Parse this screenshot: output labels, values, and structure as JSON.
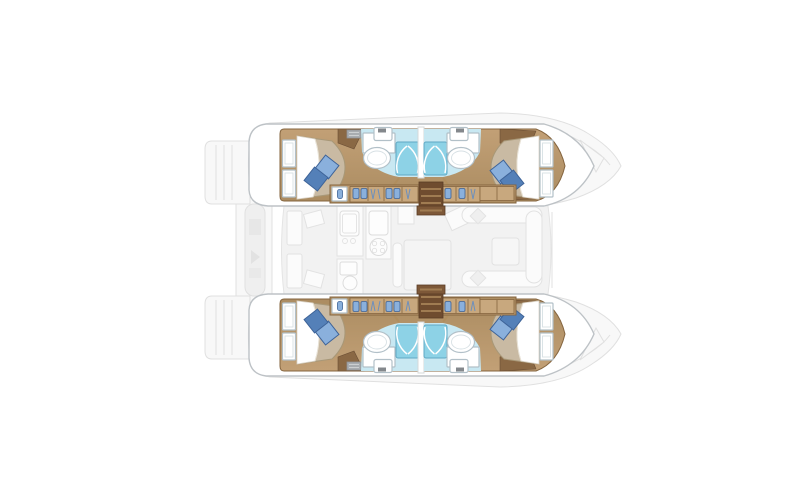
{
  "app": {
    "type": "catamaran-deck-floorplan",
    "view": "top-down",
    "orientation": "bow-right"
  },
  "canvas": {
    "width": 800,
    "height": 500
  },
  "palette": {
    "bg": "#FFFFFF",
    "faint-fill": "#F8F8F8",
    "faint-fill-2": "#EFEFEF",
    "faint-stroke": "#E0E0E0",
    "salon-fill": "#F2F2F2",
    "salon-stroke": "#E4E4E4",
    "furn-fill": "#FBFBFB",
    "furn-stroke": "#E2E2E2",
    "hull-white": "#FFFFFF",
    "hull-stroke": "#BDC2C6",
    "wood": "#B6936B",
    "wood-light": "#C8A87E",
    "wood-dark": "#8A6844",
    "wood-edge": "#85653F",
    "stairs": "#6F4C2F",
    "stair-step": "#A07C52",
    "bed": "#C9BAA3",
    "bed-edge": "#A89878",
    "sheet": "#FFFFFF",
    "pillow-light": "#8AB0DC",
    "pillow-dark": "#5480B8",
    "pillow-edge": "#3E6398",
    "bath-floor": "#C8E8F2",
    "shower": "#8DD2E6",
    "shower-edge": "#5FA8C4",
    "fixture": "#FFFFFF",
    "fixture-edge": "#B2C0C8",
    "vent": "#A8ACB0"
  },
  "vessel": {
    "hulls": [
      {
        "id": "port-hull",
        "position": "top",
        "cabins": [
          {
            "name": "aft-cabin",
            "bed": "double-berth",
            "pillows": 2,
            "shelf-units": 2,
            "corner-wardrobe": true
          },
          {
            "name": "forward-cabin",
            "bed": "double-berth",
            "pillows": 2,
            "shelf-units": 2,
            "corner-wardrobe": true
          }
        ],
        "bathrooms": [
          {
            "name": "aft-bathroom",
            "fixtures": [
              "toilet",
              "washbasin",
              "shower-stall"
            ]
          },
          {
            "name": "forward-bathroom",
            "fixtures": [
              "toilet",
              "washbasin",
              "shower-stall"
            ]
          }
        ],
        "features": [
          "hanging-locker-row",
          "companionway-stairs",
          "vent-grille"
        ]
      },
      {
        "id": "starboard-hull",
        "position": "bottom",
        "cabins": [
          {
            "name": "aft-cabin",
            "bed": "double-berth",
            "pillows": 2,
            "shelf-units": 2,
            "corner-wardrobe": true
          },
          {
            "name": "forward-cabin",
            "bed": "double-berth",
            "pillows": 2,
            "shelf-units": 2,
            "corner-wardrobe": true
          }
        ],
        "bathrooms": [
          {
            "name": "aft-bathroom",
            "fixtures": [
              "toilet",
              "washbasin",
              "shower-stall"
            ]
          },
          {
            "name": "forward-bathroom",
            "fixtures": [
              "toilet",
              "washbasin",
              "shower-stall"
            ]
          }
        ],
        "features": [
          "hanging-locker-row",
          "companionway-stairs",
          "vent-grille"
        ]
      }
    ],
    "bridgedeck": {
      "salon": [
        "galley-counters",
        "galley-sink",
        "galley-stove",
        "prep-sink",
        "salon-table",
        "salon-bench"
      ],
      "forward-cockpit": [
        "u-bench-seating",
        "cockpit-table",
        "seat-cushions"
      ],
      "stern": [
        "port-transom-platform",
        "starboard-transom-platform",
        "tender-davit"
      ],
      "bow": [
        "port-deck-hatch",
        "starboard-deck-hatch"
      ]
    },
    "totals": {
      "cabins": 4,
      "bathrooms": 4,
      "shower-stalls": 4
    }
  }
}
